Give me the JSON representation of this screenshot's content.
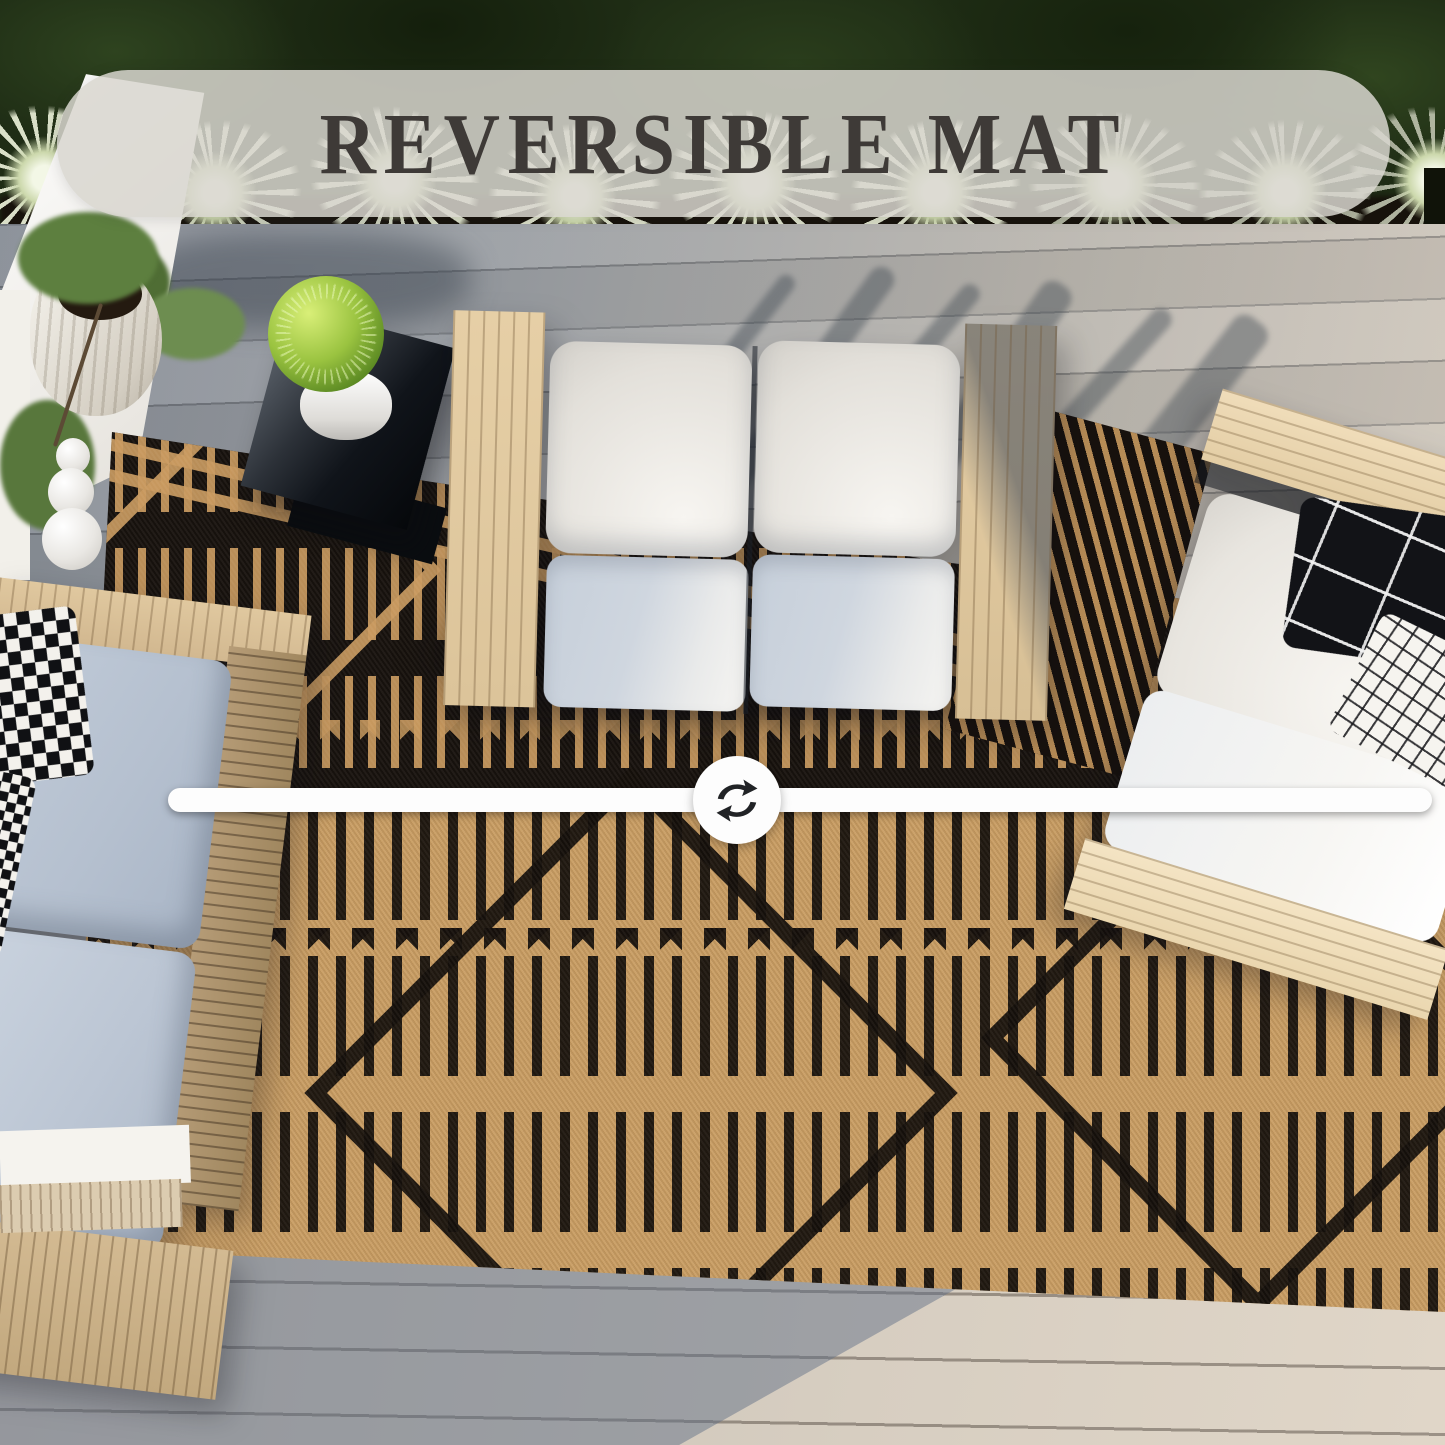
{
  "banner": {
    "title": "REVERSIBLE MAT"
  },
  "divider": {
    "icon": "swap-arrows-icon"
  },
  "palette": {
    "banner_bg": "#d8d6cf",
    "banner_text": "#3e3a37",
    "rug_black": "#16110d",
    "rug_tan": "#c5985c",
    "deck_shadow_gray": "#8e949c",
    "deck_sunlit": "#d8cfc2",
    "hedge_green": "#1f2d15",
    "agave_green": "#e4ead2",
    "cushion_white": "#f4f2ee",
    "cushion_blue_gray": "#bdc7d4",
    "wood_light": "#e6d0a8",
    "divider_white": "#fdfdfd",
    "icon_dark": "#212326"
  }
}
